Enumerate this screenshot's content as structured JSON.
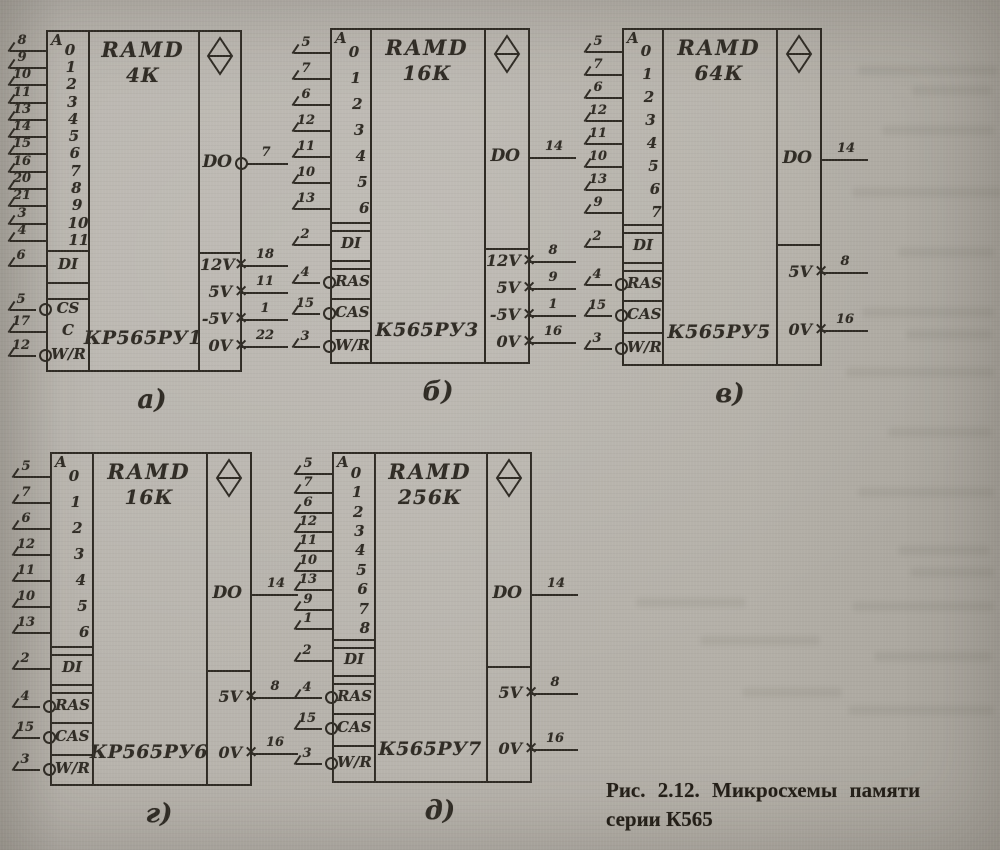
{
  "page": {
    "background_color": "#b2aea6",
    "ink_color": "#2f2b24"
  },
  "caption": {
    "line1": "Рис. 2.12. Микросхемы памяти",
    "line2": "серии К565"
  },
  "chips": [
    {
      "id": "a",
      "label": "а)",
      "title_line1": "RAMD",
      "title_line2": "4К",
      "part_number": "КР565РУ1",
      "address_header": "A",
      "addresses": [
        {
          "digit": "0",
          "pin": "8"
        },
        {
          "digit": "1",
          "pin": "9"
        },
        {
          "digit": "2",
          "pin": "10"
        },
        {
          "digit": "3",
          "pin": "11"
        },
        {
          "digit": "4",
          "pin": "13"
        },
        {
          "digit": "5",
          "pin": "14"
        },
        {
          "digit": "6",
          "pin": "15"
        },
        {
          "digit": "7",
          "pin": "16"
        },
        {
          "digit": "8",
          "pin": "20"
        },
        {
          "digit": "9",
          "pin": "21"
        },
        {
          "digit": "10",
          "pin": "3"
        },
        {
          "digit": "11",
          "pin": "4"
        }
      ],
      "controls": [
        {
          "label": "DI",
          "pin": "6",
          "bubble": false
        },
        {
          "label": "CS",
          "pin": "5",
          "bubble": true
        },
        {
          "label": "C",
          "pin": "17",
          "bubble": false
        },
        {
          "label": "W/R",
          "pin": "12",
          "bubble": true
        }
      ],
      "output": {
        "label": "DO",
        "pin": "7",
        "bubble": true
      },
      "powers": [
        {
          "label": "12V",
          "pin": "18"
        },
        {
          "label": "5V",
          "pin": "11"
        },
        {
          "label": "-5V",
          "pin": "1"
        },
        {
          "label": "0V",
          "pin": "22"
        }
      ]
    },
    {
      "id": "b",
      "label": "б)",
      "title_line1": "RAMD",
      "title_line2": "16К",
      "part_number": "К565РУ3",
      "address_header": "A",
      "addresses": [
        {
          "digit": "0",
          "pin": "5"
        },
        {
          "digit": "1",
          "pin": "7"
        },
        {
          "digit": "2",
          "pin": "6"
        },
        {
          "digit": "3",
          "pin": "12"
        },
        {
          "digit": "4",
          "pin": "11"
        },
        {
          "digit": "5",
          "pin": "10"
        },
        {
          "digit": "6",
          "pin": "13"
        }
      ],
      "controls": [
        {
          "label": "DI",
          "pin": "2",
          "bubble": false
        },
        {
          "label": "RAS",
          "pin": "4",
          "bubble": true
        },
        {
          "label": "CAS",
          "pin": "15",
          "bubble": true
        },
        {
          "label": "W/R",
          "pin": "3",
          "bubble": true
        }
      ],
      "output": {
        "label": "DO",
        "pin": "14",
        "bubble": false
      },
      "powers": [
        {
          "label": "12V",
          "pin": "8"
        },
        {
          "label": "5V",
          "pin": "9"
        },
        {
          "label": "-5V",
          "pin": "1"
        },
        {
          "label": "0V",
          "pin": "16"
        }
      ]
    },
    {
      "id": "v",
      "label": "в)",
      "title_line1": "RAMD",
      "title_line2": "64К",
      "part_number": "К565РУ5",
      "address_header": "A",
      "addresses": [
        {
          "digit": "0",
          "pin": "5"
        },
        {
          "digit": "1",
          "pin": "7"
        },
        {
          "digit": "2",
          "pin": "6"
        },
        {
          "digit": "3",
          "pin": "12"
        },
        {
          "digit": "4",
          "pin": "11"
        },
        {
          "digit": "5",
          "pin": "10"
        },
        {
          "digit": "6",
          "pin": "13"
        },
        {
          "digit": "7",
          "pin": "9"
        }
      ],
      "controls": [
        {
          "label": "DI",
          "pin": "2",
          "bubble": false
        },
        {
          "label": "RAS",
          "pin": "4",
          "bubble": true
        },
        {
          "label": "CAS",
          "pin": "15",
          "bubble": true
        },
        {
          "label": "W/R",
          "pin": "3",
          "bubble": true
        }
      ],
      "output": {
        "label": "DO",
        "pin": "14",
        "bubble": false
      },
      "powers": [
        {
          "label": "5V",
          "pin": "8"
        },
        {
          "label": "0V",
          "pin": "16"
        }
      ]
    },
    {
      "id": "g",
      "label": "г)",
      "title_line1": "RAMD",
      "title_line2": "16К",
      "part_number": "КР565РУ6",
      "address_header": "A",
      "addresses": [
        {
          "digit": "0",
          "pin": "5"
        },
        {
          "digit": "1",
          "pin": "7"
        },
        {
          "digit": "2",
          "pin": "6"
        },
        {
          "digit": "3",
          "pin": "12"
        },
        {
          "digit": "4",
          "pin": "11"
        },
        {
          "digit": "5",
          "pin": "10"
        },
        {
          "digit": "6",
          "pin": "13"
        }
      ],
      "controls": [
        {
          "label": "DI",
          "pin": "2",
          "bubble": false
        },
        {
          "label": "RAS",
          "pin": "4",
          "bubble": true
        },
        {
          "label": "CAS",
          "pin": "15",
          "bubble": true
        },
        {
          "label": "W/R",
          "pin": "3",
          "bubble": true
        }
      ],
      "output": {
        "label": "DO",
        "pin": "14",
        "bubble": false
      },
      "powers": [
        {
          "label": "5V",
          "pin": "8"
        },
        {
          "label": "0V",
          "pin": "16"
        }
      ]
    },
    {
      "id": "d",
      "label": "д)",
      "title_line1": "RAMD",
      "title_line2": "256К",
      "part_number": "К565РУ7",
      "address_header": "A",
      "addresses": [
        {
          "digit": "0",
          "pin": "5"
        },
        {
          "digit": "1",
          "pin": "7"
        },
        {
          "digit": "2",
          "pin": "6"
        },
        {
          "digit": "3",
          "pin": "12"
        },
        {
          "digit": "4",
          "pin": "11"
        },
        {
          "digit": "5",
          "pin": "10"
        },
        {
          "digit": "6",
          "pin": "13"
        },
        {
          "digit": "7",
          "pin": "9"
        },
        {
          "digit": "8",
          "pin": "1"
        }
      ],
      "controls": [
        {
          "label": "DI",
          "pin": "2",
          "bubble": false
        },
        {
          "label": "RAS",
          "pin": "4",
          "bubble": true
        },
        {
          "label": "CAS",
          "pin": "15",
          "bubble": true
        },
        {
          "label": "W/R",
          "pin": "3",
          "bubble": true
        }
      ],
      "output": {
        "label": "DO",
        "pin": "14",
        "bubble": false
      },
      "powers": [
        {
          "label": "5V",
          "pin": "8"
        },
        {
          "label": "0V",
          "pin": "16"
        }
      ]
    }
  ]
}
